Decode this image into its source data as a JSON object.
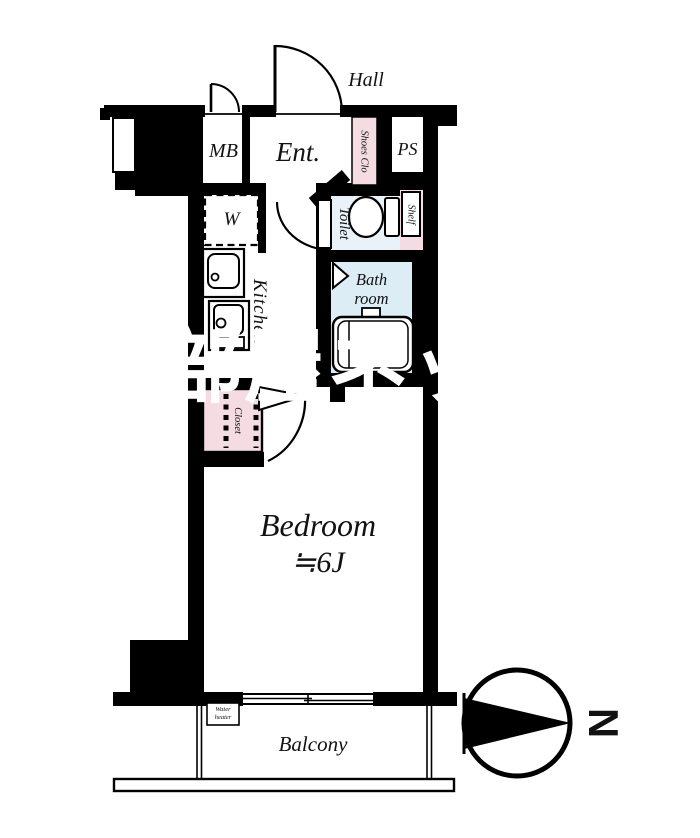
{
  "colors": {
    "wall": "#000000",
    "accent_pink": "#f5dce2",
    "bath_blue": "#dcedf5",
    "toilet_blue": "#e9f2f8",
    "watermark_white": "#ffffff"
  },
  "floor_plan": {
    "hall_label": "Hall",
    "rooms": {
      "mb": "MB",
      "entrance": "Ent.",
      "shoes_closet": "Shoes Clo",
      "pipe_space": "PS",
      "toilet": "Toilet",
      "shelf": "Shelf",
      "bathroom_line1": "Bath",
      "bathroom_line2": "room",
      "washer": "W",
      "kitchen": "Kitchen",
      "closet": "Closet",
      "bedroom_name": "Bedroom",
      "bedroom_size": "≒6J",
      "balcony": "Balcony"
    },
    "water_heater": {
      "line1": "Water",
      "line2": "heater"
    },
    "compass": {
      "north": "N"
    },
    "watermark": "お部屋ネット"
  }
}
